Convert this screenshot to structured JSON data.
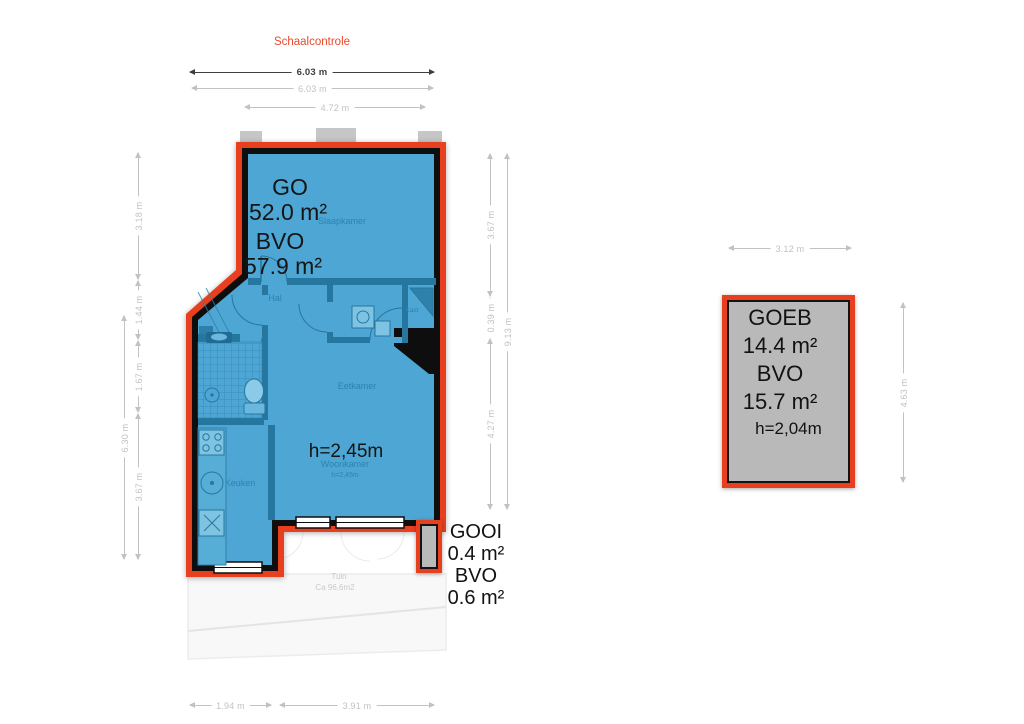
{
  "colors": {
    "outline_red": "#e8401f",
    "floor_blue": "#4da6d3",
    "wall_black": "#0e0e0e",
    "interior_wall_blue": "#26779f",
    "annex_gray": "#b9b9b9",
    "dim_light": "#c2c2c2",
    "dim_dark": "#3f3f3f",
    "scale_title_red": "#e8492e"
  },
  "scale": {
    "title": "Schaalcontrole",
    "dim_total": "6.03 m",
    "dim_outer": "6.03 m",
    "dim_inner": "4.72 m"
  },
  "main_plan": {
    "go_label": "GO",
    "go_value": "52.0 m²",
    "bvo_label": "BVO",
    "bvo_value": "57.9 m²",
    "ceiling_height": "h=2,45m",
    "rooms": {
      "slaapkamer": "Slaapkamer",
      "hal": "Hal",
      "eetkamer": "Eetkamer",
      "woonkamer": "Woonkamer",
      "woonkamer_height": "h=2,45m",
      "keuken": "Keuken",
      "kast": "Kast"
    },
    "garden": {
      "name": "Tuin",
      "area": "Ca 96,6m2"
    },
    "dims": {
      "left_outer": "6.30 m",
      "left_top": "3.18 m",
      "left_mid1": "1.44 m",
      "left_mid2": "1.67 m",
      "left_bottom": "3.67 m",
      "right_top": "3.67 m",
      "right_mid": "0.39 m",
      "right_bottom": "4.27 m",
      "right_outer": "9.13 m",
      "bottom_left": "1.94 m",
      "bottom_right": "3.91 m"
    }
  },
  "gooi": {
    "name": "GOOI",
    "go_value": "0.4 m²",
    "bvo_label": "BVO",
    "bvo_value": "0.6 m²"
  },
  "goeb": {
    "name": "GOEB",
    "go_value": "14.4 m²",
    "bvo_label": "BVO",
    "bvo_value": "15.7 m²",
    "ceiling_height": "h=2,04m",
    "dim_top": "3.12 m",
    "dim_right": "4.63 m"
  }
}
